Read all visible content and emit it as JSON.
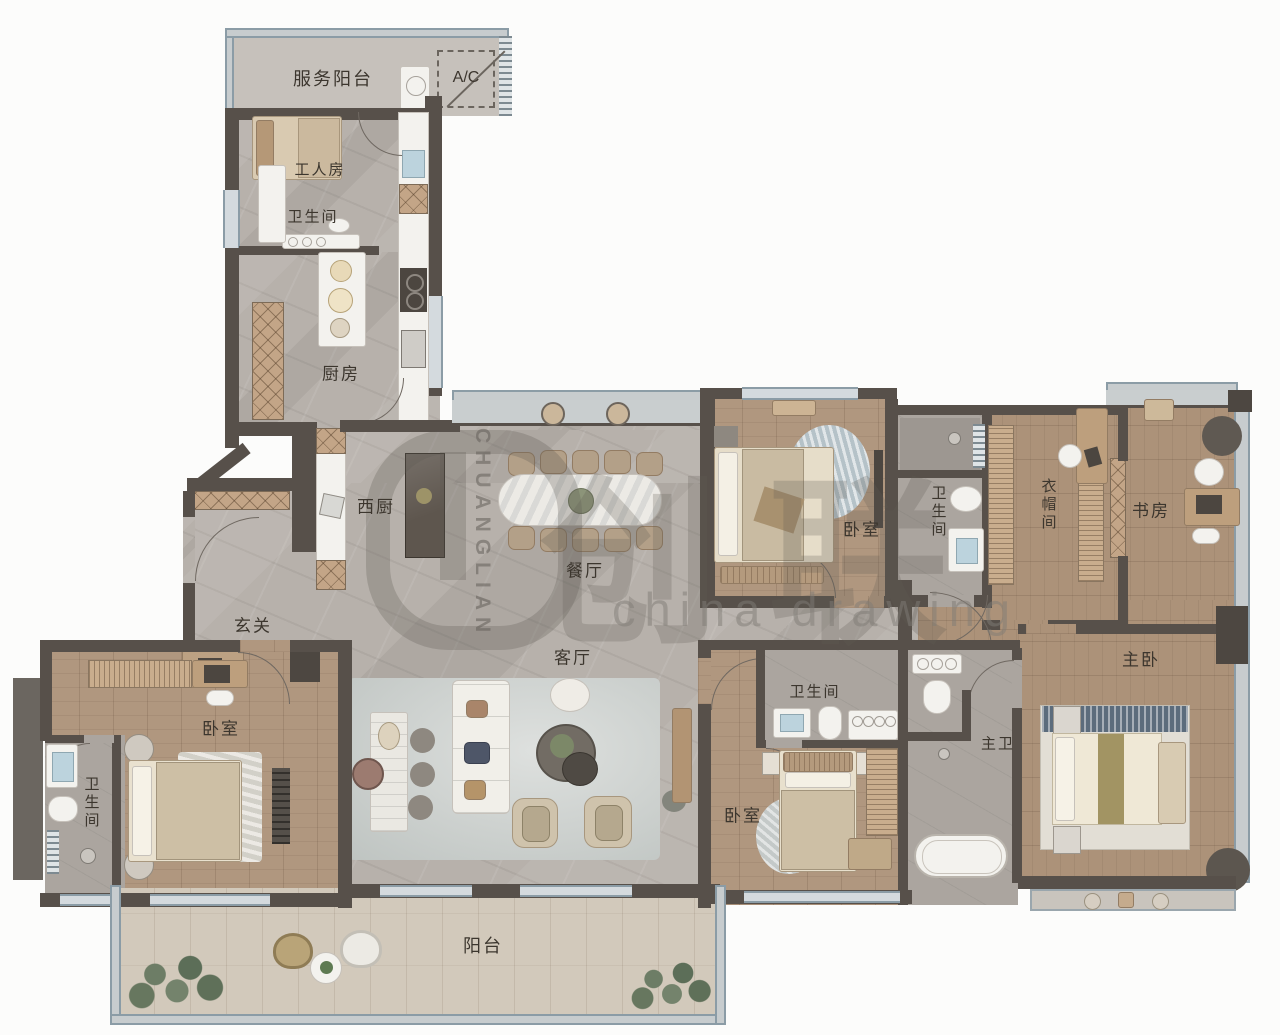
{
  "plan": {
    "type": "residential floor plan",
    "labels": {
      "service_balcony": "服务阳台",
      "ac_unit": "A/C",
      "maid_room": "工人房",
      "maid_bath": "卫生间",
      "kitchen": "厨房",
      "west_kitchen": "西厨",
      "dining_room": "餐厅",
      "foyer": "玄关",
      "living_room": "客厅",
      "bedroom_top": "卧室",
      "bath_top": "卫生间",
      "cloakroom": "衣帽间",
      "study": "书房",
      "master_bedroom": "主卧",
      "master_bath": "主卫",
      "bath_mid": "卫生间",
      "bedroom_mid": "卧室",
      "bedroom_left": "卧室",
      "bath_left": "卫生间",
      "balcony": "阳台"
    },
    "watermark": {
      "vertical_brand": "CHUANGLIAN",
      "cjk_brand": "创联",
      "latin_brand": "china drawing"
    },
    "colors": {
      "wall": "#57504a",
      "marble_floor": "#b7b1ab",
      "wood_floor": "#ac9279",
      "deck_floor": "#d2c9bb",
      "window": "#d4dade",
      "window_frame": "#8b9ca6",
      "cabinet_tan": "#c3a587",
      "fixture_white": "#f3f2ee",
      "label_text": "#3c362e"
    }
  }
}
